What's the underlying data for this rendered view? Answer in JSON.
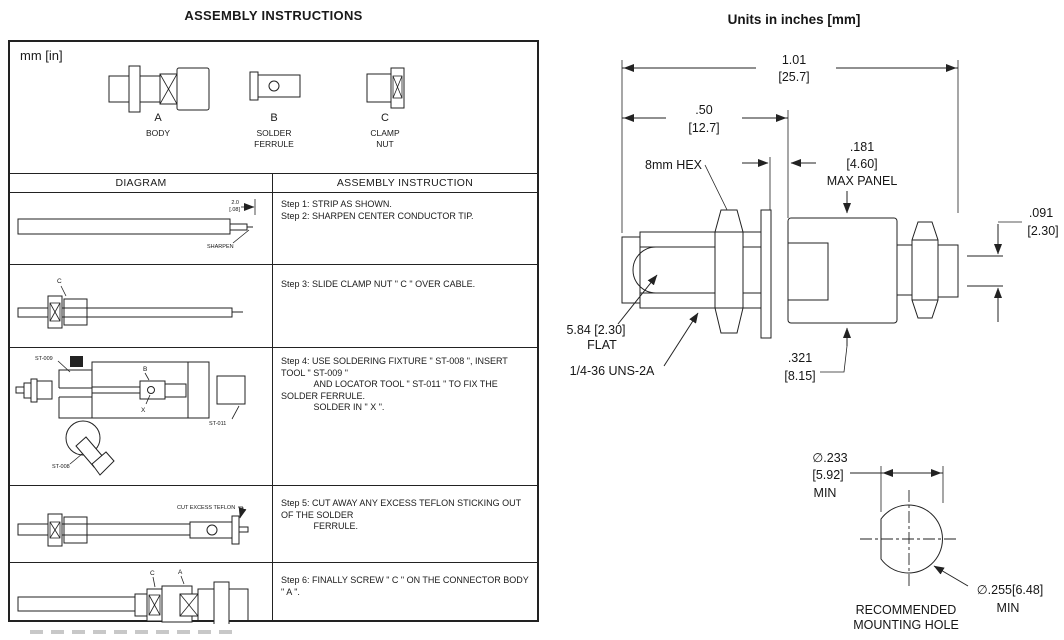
{
  "left": {
    "title": "ASSEMBLY INSTRUCTIONS",
    "units_note": "mm [in]",
    "parts": [
      {
        "letter": "A",
        "name": "BODY"
      },
      {
        "letter": "B",
        "name": "SOLDER\nFERRULE"
      },
      {
        "letter": "C",
        "name": "CLAMP\nNUT"
      }
    ],
    "table": {
      "diagram_header": "DIAGRAM",
      "instruction_header": "ASSEMBLY INSTRUCTION",
      "rows": [
        {
          "instruction": "Step 1: STRIP AS SHOWN.\nStep 2: SHARPEN CENTER CONDUCTOR TIP."
        },
        {
          "instruction": "Step 3: SLIDE CLAMP NUT \" C \" OVER CABLE."
        },
        {
          "instruction": "Step 4: USE SOLDERING FIXTURE \" ST-008 \", INSERT TOOL \" ST-009 \"\n             AND LOCATOR TOOL \" ST-011 \" TO FIX THE SOLDER FERRULE.\n             SOLDER IN \" X \"."
        },
        {
          "instruction": "Step 5: CUT AWAY ANY EXCESS TEFLON STICKING OUT OF THE SOLDER\n             FERRULE."
        },
        {
          "instruction": "Step 6: FINALLY SCREW \" C \" ON THE CONNECTOR BODY \" A \"."
        }
      ]
    },
    "diagram_labels": {
      "strip_dim_top": "2.0",
      "strip_dim_bottom": "[.08]",
      "sharpen": "SHARPEN",
      "clamp_nut_c": "C",
      "st009": "ST-009",
      "st011": "ST-011",
      "st008": "ST-008",
      "ferrule_b": "B",
      "solder_x": "X",
      "cut_teflon": "CUT EXCESS TEFLON",
      "final_c": "C",
      "final_a": "A"
    }
  },
  "right": {
    "title": "Units in inches [mm]",
    "dims": {
      "overall_in": "1.01",
      "overall_mm": "[25.7]",
      "half_in": ".50",
      "half_mm": "[12.7]",
      "panel_in": ".181",
      "panel_mm": "[4.60]",
      "panel_note": "MAX PANEL",
      "hex": "8mm HEX",
      "pin_in": ".091",
      "pin_mm": "[2.30]",
      "flat_val": "5.84 [2.30]",
      "flat_note": "FLAT",
      "thread": "1/4-36 UNS-2A",
      "len_in": ".321",
      "len_mm": "[8.15]",
      "hole_flat_d": "∅.233",
      "hole_flat_mm": "[5.92]",
      "hole_flat_min": "MIN",
      "hole_d": "∅.255[6.48]",
      "hole_d_min": "MIN",
      "hole_caption1": "RECOMMENDED",
      "hole_caption2": "MOUNTING HOLE"
    }
  }
}
